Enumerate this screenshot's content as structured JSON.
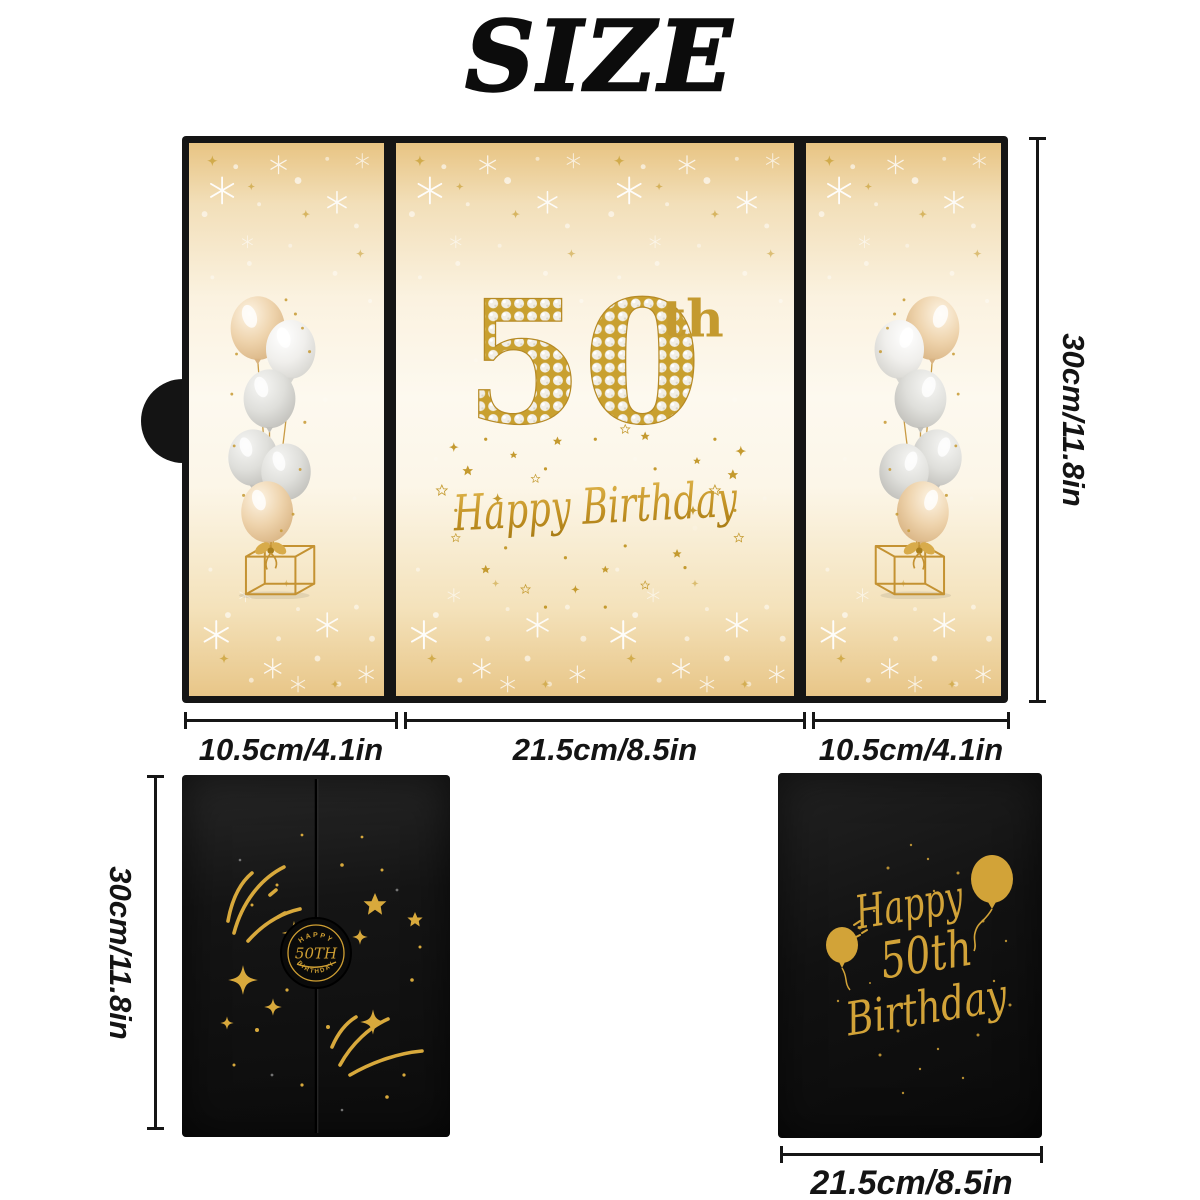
{
  "title": "SIZE",
  "open_card": {
    "number": "50",
    "suffix": "th",
    "greeting": "Happy Birthday",
    "height_label": "30cm/11.8in",
    "left_panel_width_label": "10.5cm/4.1in",
    "center_panel_width_label": "21.5cm/8.5in",
    "right_panel_width_label": "10.5cm/4.1in"
  },
  "front_card": {
    "badge_top": "HAPPY",
    "badge_middle": "50TH",
    "badge_bottom": "BIRTHDAY",
    "height_label": "30cm/11.8in"
  },
  "back_card": {
    "line1": "Happy",
    "line2": "50th",
    "line3": "Birthday",
    "width_label": "21.5cm/8.5in"
  },
  "icons": {
    "side_panels": "balloon-bouquet-with-gift-box",
    "front_card": "gold-fireworks-and-stars",
    "front_card_badge": "circular-50th-seal",
    "back_card": "gold-balloons-with-script"
  },
  "colors": {
    "gold": "#c9992e",
    "deep_gold": "#b8860b",
    "card_black": "#141414",
    "panel_cream": "#fdf8ec",
    "panel_gold_edge": "#e9c98c",
    "background": "#ffffff",
    "dimension_text": "#141414"
  }
}
